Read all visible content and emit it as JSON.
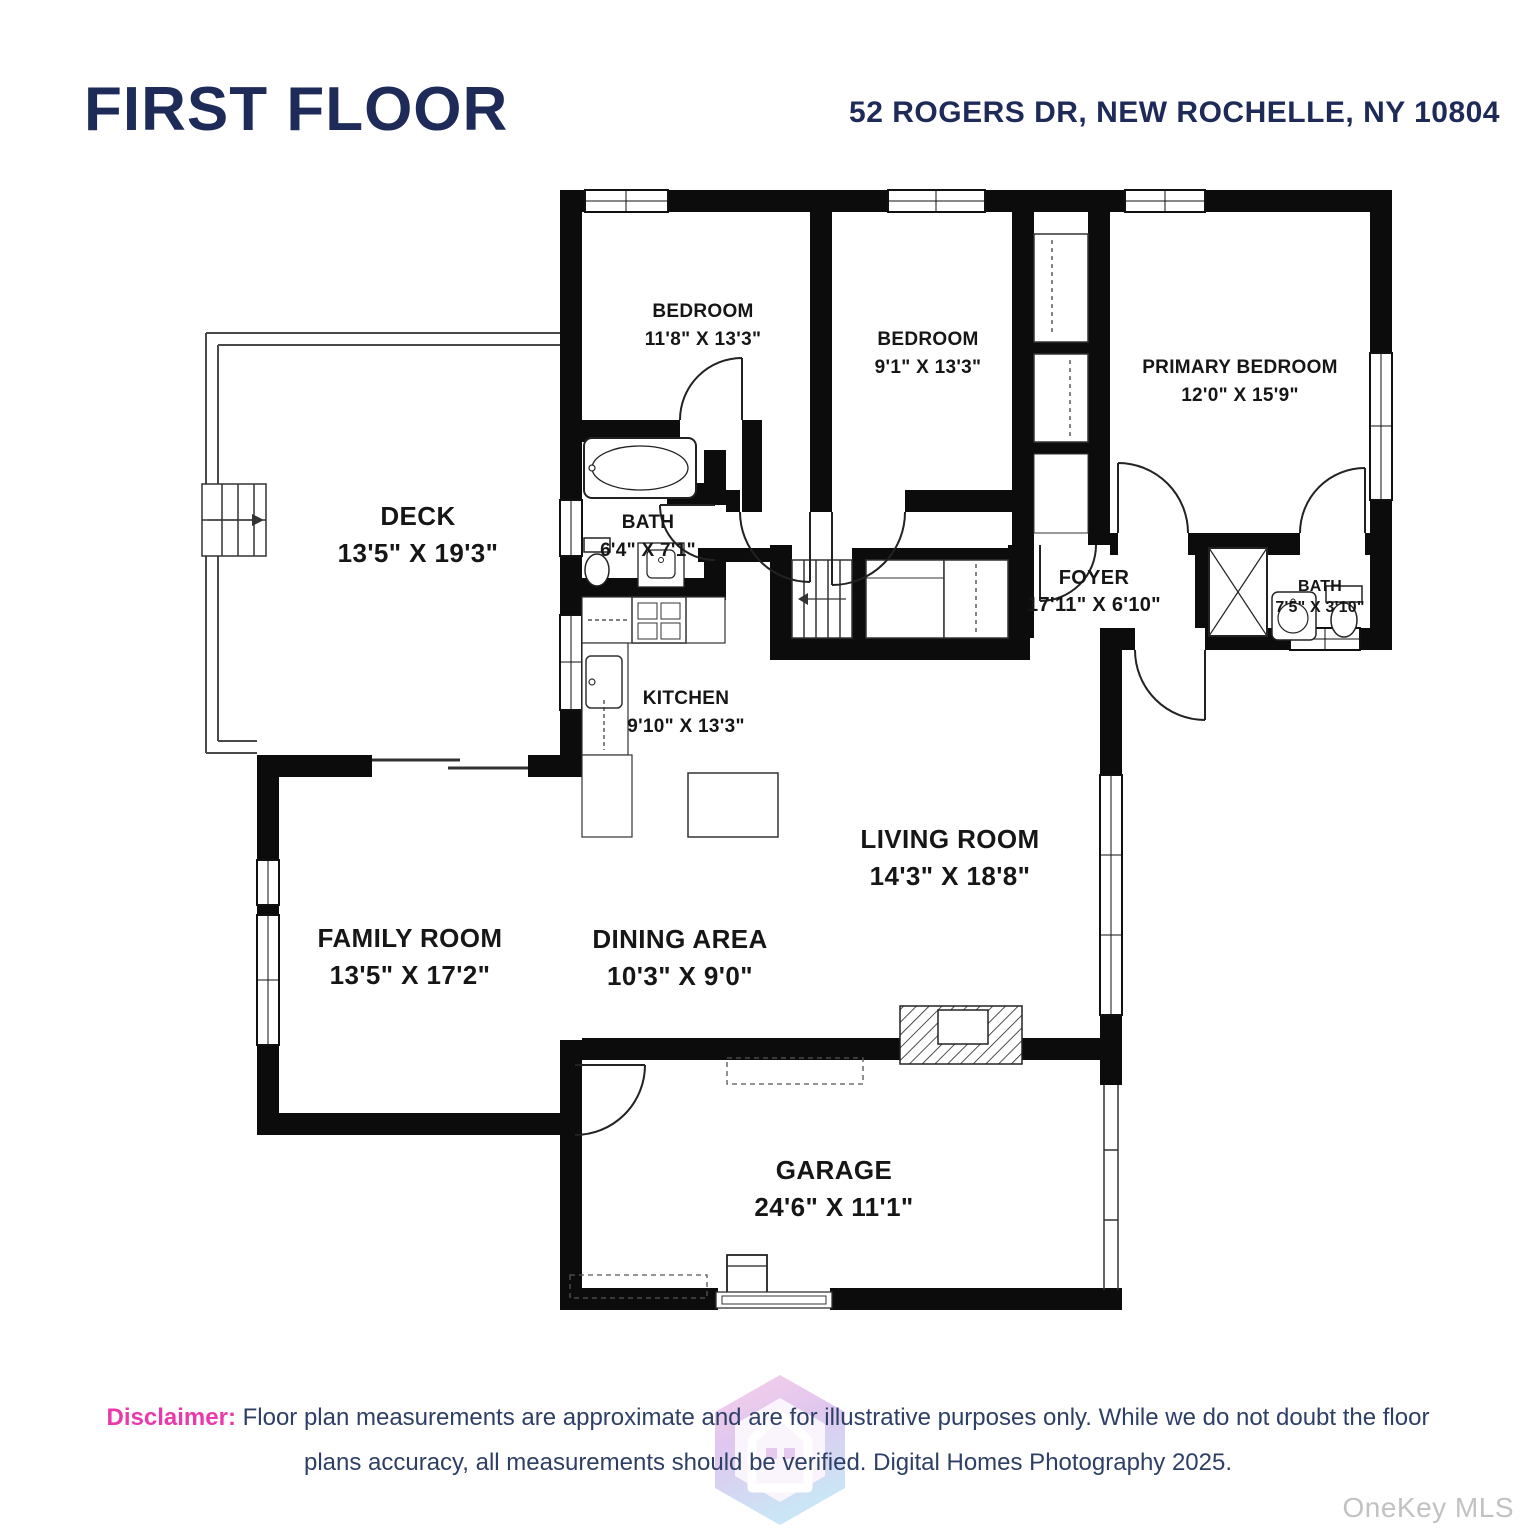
{
  "header": {
    "title": "FIRST FLOOR",
    "address": "52 ROGERS DR, NEW ROCHELLE, NY 10804"
  },
  "rooms": [
    {
      "name": "BEDROOM",
      "dims": "11'8\" X 13'3\""
    },
    {
      "name": "BEDROOM",
      "dims": "9'1\" X 13'3\""
    },
    {
      "name": "PRIMARY BEDROOM",
      "dims": "12'0\" X 15'9\""
    },
    {
      "name": "DECK",
      "dims": "13'5\" X 19'3\""
    },
    {
      "name": "BATH",
      "dims": "6'4\" X 7'1\""
    },
    {
      "name": "FOYER",
      "dims": "17'11\" X 6'10\""
    },
    {
      "name": "BATH",
      "dims": "7'5\" X 3'10\""
    },
    {
      "name": "KITCHEN",
      "dims": "9'10\" X 13'3\""
    },
    {
      "name": "LIVING ROOM",
      "dims": "14'3\" X 18'8\""
    },
    {
      "name": "DINING AREA",
      "dims": "10'3\" X 9'0\""
    },
    {
      "name": "FAMILY ROOM",
      "dims": "13'5\" X 17'2\""
    },
    {
      "name": "GARAGE",
      "dims": "24'6\" X 11'1\""
    }
  ],
  "disclaimer": {
    "label": "Disclaimer:",
    "text": " Floor plan measurements are approximate and are for illustrative purposes only. While we do not doubt the floor plans accuracy, all measurements should be verified. Digital Homes Photography 2025."
  },
  "watermark": "OneKey MLS",
  "colors": {
    "title": "#1e2a58",
    "walls": "#0c0c0c",
    "disclaimer_label": "#e93aac",
    "disclaimer_text": "#2e3f66",
    "watermark": "#c2c2c2"
  }
}
